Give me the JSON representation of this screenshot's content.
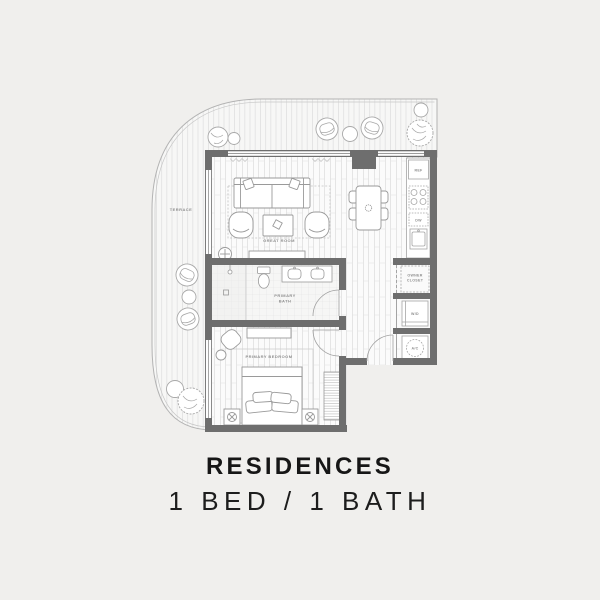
{
  "title_block": {
    "title": "RESIDENCES",
    "subtitle": "1 BED / 1 BATH"
  },
  "floorplan": {
    "rooms": {
      "terrace": "TERRACE",
      "great_room": "GREAT ROOM",
      "primary_bath_line1": "PRIMARY",
      "primary_bath_line2": "BATH",
      "primary_bedroom": "PRIMARY BEDROOM",
      "owner_closet_line1": "OWNER",
      "owner_closet_line2": "CLOSET",
      "washer_dryer": "W/D",
      "air_conditioner": "A/C",
      "refrigerator": "REF",
      "dishwasher": "DW"
    },
    "colors": {
      "background": "#f0efed",
      "wall": "#6e6e6e",
      "floor": "#fbfbfb",
      "hatch_line": "#dcdcdc",
      "furniture_stroke": "#9a9a9a",
      "label": "#8f8f8f",
      "title_text": "#161616"
    }
  }
}
